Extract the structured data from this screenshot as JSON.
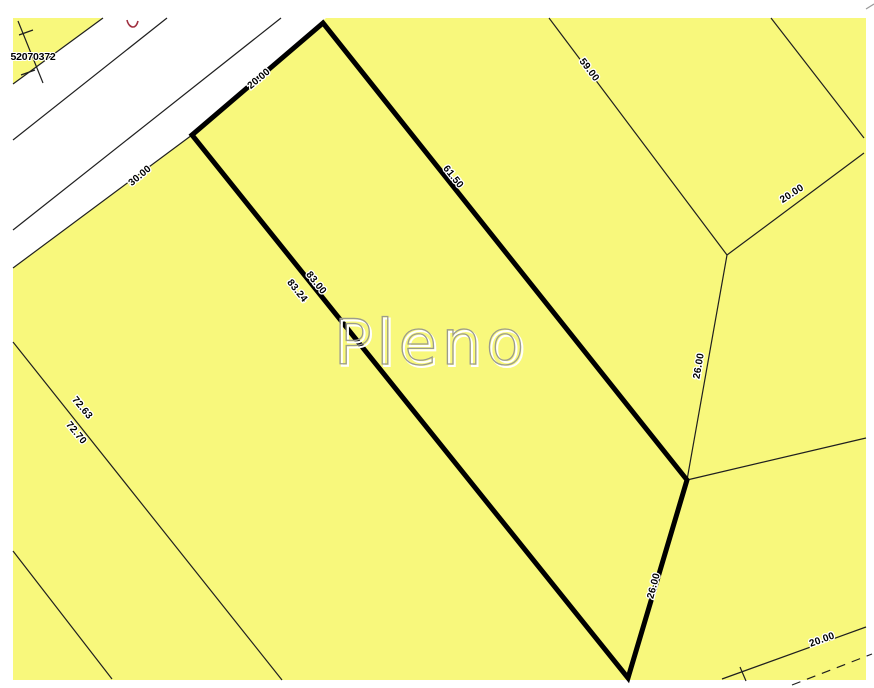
{
  "map": {
    "watermark": "Pleno",
    "corner_parcel": {
      "id": "52070372"
    },
    "highlighted_lot": {
      "front_width": "20.00",
      "right_side": "61.50",
      "left_side_outer": "83.00",
      "left_side_inner": "83.24",
      "rear_side": "26.00"
    },
    "road_frontage_segment": "30.00",
    "neighbors": {
      "upper_right_side": "59.00",
      "right_width": "20.00",
      "right_depth": "26.00",
      "left_depth_outer": "72.63",
      "left_depth_inner": "72.70",
      "bottom_right_segment": "20.00"
    },
    "colors": {
      "parcel_fill": "#F8F87C",
      "road_fill": "#FFFFFF",
      "boundary_thick": "#000000",
      "boundary_thin": "#1F1F1F",
      "watermark_stroke": "#9B9B8D",
      "watermark_highlight": "#FFFFFF",
      "red_mark": "#A03040"
    }
  }
}
